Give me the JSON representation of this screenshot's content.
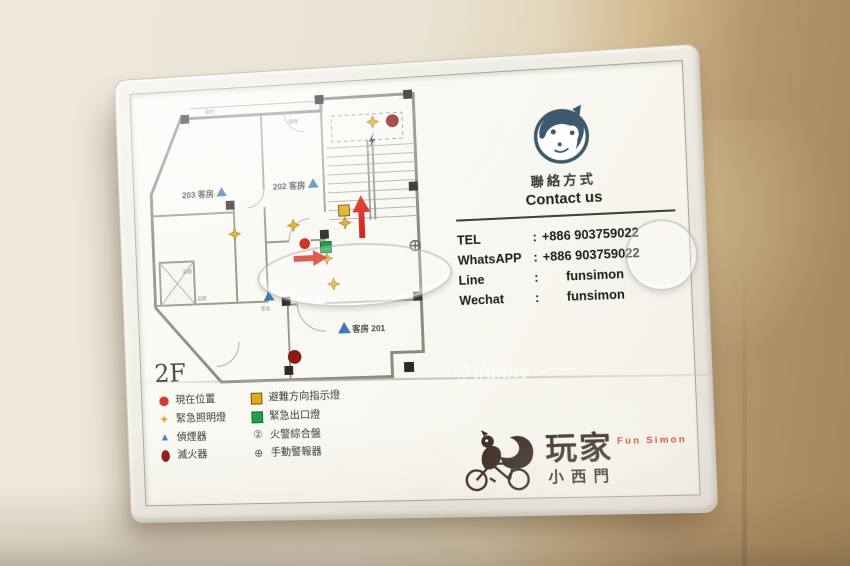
{
  "sign": {
    "floor_label": "2F",
    "plan": {
      "labels": {
        "room203": "203 客房",
        "room202": "202 客房",
        "room201": "客房 201",
        "balcony": "陽台",
        "stairs": "樓梯",
        "bath1": "浴廁",
        "bath2": "浴廁",
        "pantry": "茶水"
      }
    },
    "contact": {
      "heading_zh": "聯絡方式",
      "heading_en": "Contact us",
      "colon": ":",
      "rows": [
        {
          "label": "TEL",
          "value": "+886 903759022"
        },
        {
          "label": "WhatsAPP",
          "value": "+886 903759022"
        },
        {
          "label": "Line",
          "value": "funsimon"
        },
        {
          "label": "Wechat",
          "value": "funsimon"
        }
      ]
    },
    "legend": {
      "col1": [
        {
          "symbol": "current-position",
          "label": "現在位置"
        },
        {
          "symbol": "emergency-light",
          "glyph": "✦",
          "label": "緊急照明燈"
        },
        {
          "symbol": "smoke-detector",
          "glyph": "▲",
          "label": "偵煙器"
        },
        {
          "symbol": "fire-extinguisher",
          "label": "滅火器"
        }
      ],
      "col2": [
        {
          "symbol": "escape-direction-light",
          "label": "避難方向指示燈"
        },
        {
          "symbol": "emergency-exit-light",
          "label": "緊急出口燈"
        },
        {
          "symbol": "fire-alarm-panel",
          "glyph": "②",
          "label": "火警綜合盤"
        },
        {
          "symbol": "manual-alarm",
          "glyph": "⊕",
          "label": "手動警報器"
        }
      ]
    },
    "logo": {
      "name_zh": "玩家",
      "name_en": "Fun Simon",
      "branch": "小西門"
    },
    "watermark": {
      "text": "ifunny"
    },
    "colors": {
      "accent_red": "#d2402a",
      "mascot_navy": "#3c5a6b",
      "symbol_red": "#cc3326",
      "symbol_darkred": "#8e1a14",
      "symbol_yellow": "#dfab20",
      "symbol_green": "#1f9e4b",
      "symbol_blue": "#3d7ab5",
      "logo_brown": "#2a1a0e"
    }
  }
}
